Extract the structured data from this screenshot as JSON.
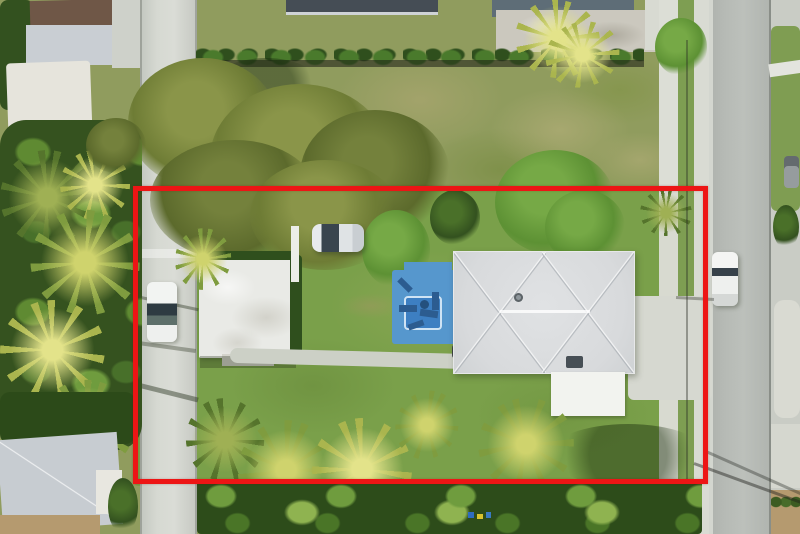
{
  "canvas": {
    "width_px": 800,
    "height_px": 534
  },
  "image_type": "aerial-drone-photograph-of-residential-property",
  "annotation": {
    "name": "property-boundary",
    "shape": "rectangle",
    "color": "#ed1515",
    "stroke_px": 5,
    "left_px": 133,
    "top_px": 186,
    "right_px": 708,
    "bottom_px": 484
  },
  "colors": {
    "boundary_red": "#ed1515",
    "lawn_green": "#7aa04a",
    "field_green": "#909c5e",
    "field_tan": "#b6ac78",
    "canopy_olive": "#6e7c35",
    "tree_bright": "#5d9134",
    "tree_dark": "#33511f",
    "hedge_green": "#2f4f1d",
    "palm_frond": "#7f9c3f",
    "palm_yellow_frond": "#aab54e",
    "palm_yellow_core": "#e3e38a",
    "asphalt": "#b6bab5",
    "concrete": "#d6d9d2",
    "sidewalk": "#d9dbd3",
    "roof_main": "#d8dadc",
    "roof_flat": "#e9eae6",
    "shed_white": "#f2f3ef",
    "pool_deck": "#5697cd",
    "pool_water": "#3d7fc2",
    "roof_brown": "#6f5747",
    "roof_dark": "#454d55",
    "roof_blue_gray": "#5e6d77",
    "roof_sw_gray": "#c7ccd1",
    "dirt_tan": "#b59a6f",
    "car_white": "#f2f4f2"
  },
  "scene": {
    "description": "Overhead aerial view of a single-family lot outlined in red, with gray hip-roof house, blue pool deck, detached flat-roof building, white shed, tropical palms, vacant grass lot to the north, concrete alley on the west and asphalt street on the east",
    "objects": [
      "red-property-boundary-overlay",
      "main-house-gray-hip-roof",
      "blue-pool-deck-with-loungers",
      "detached-flat-roof-building",
      "white-storage-shed",
      "driveway-apron-to-east-road",
      "front-lawn-with-palm-trees",
      "vacant-patchy-grass-lot-north",
      "hedge-row-with-fence",
      "large-olive-tree-canopy",
      "west-concrete-alley",
      "east-asphalt-street-with-sidewalk",
      "white-van-parked-on-alley",
      "white-car-parked-in-driveway",
      "white-car-parked-on-east-street",
      "northwest-neighbor-house",
      "southwest-neighbor-house-gray-roof",
      "dense-tropical-vegetation-south",
      "power-line-shadows-on-street"
    ]
  }
}
